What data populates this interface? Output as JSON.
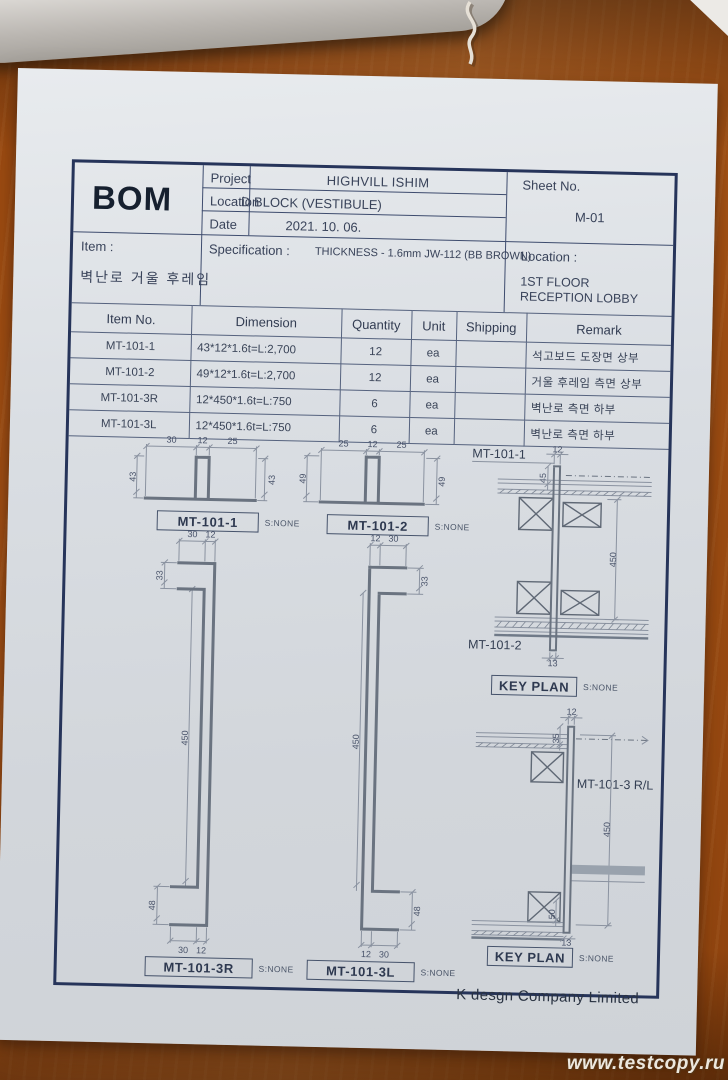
{
  "header": {
    "bom_title": "BOM",
    "project_label": "Project",
    "project_value": "HIGHVILL ISHIM",
    "location_label": "Location",
    "location_value": "D BLOCK (VESTIBULE)",
    "date_label": "Date",
    "date_value": "2021. 10. 06.",
    "sheet_label": "Sheet No.",
    "sheet_value": "M-01"
  },
  "item_block": {
    "item_label": "Item :",
    "item_value": "벽난로 거울 후레임",
    "spec_label": "Specification :",
    "spec_value": "THICKNESS - 1.6mm JW-112 (BB BROWN)",
    "location_label": "Location :",
    "location_line1": "1ST FLOOR",
    "location_line2": "RECEPTION LOBBY"
  },
  "parts_table": {
    "headers": [
      "Item No.",
      "Dimension",
      "Quantity",
      "Unit",
      "Shipping",
      "Remark"
    ],
    "rows": [
      {
        "item_no": "MT-101-1",
        "dimension": "43*12*1.6t=L:2,700",
        "quantity": "12",
        "unit": "ea",
        "shipping": "",
        "remark": "석고보드 도장면 상부"
      },
      {
        "item_no": "MT-101-2",
        "dimension": "49*12*1.6t=L:2,700",
        "quantity": "12",
        "unit": "ea",
        "shipping": "",
        "remark": "거울 후레임 측면 상부"
      },
      {
        "item_no": "MT-101-3R",
        "dimension": "12*450*1.6t=L:750",
        "quantity": "6",
        "unit": "ea",
        "shipping": "",
        "remark": "벽난로 측면 하부"
      },
      {
        "item_no": "MT-101-3L",
        "dimension": "12*450*1.6t=L:750",
        "quantity": "6",
        "unit": "ea",
        "shipping": "",
        "remark": "벽난로 측면 하부"
      }
    ]
  },
  "drawings": {
    "p1": {
      "label": "MT-101-1",
      "scale": "S:NONE",
      "top": [
        "30",
        "12",
        "25"
      ],
      "left_h": "43",
      "right_h": "43"
    },
    "p2": {
      "label": "MT-101-2",
      "scale": "S:NONE",
      "top": [
        "25",
        "12",
        "25"
      ],
      "left_h": "49",
      "right_h": "49"
    },
    "s3r": {
      "label": "MT-101-3R",
      "scale": "S:NONE",
      "top": [
        "30",
        "12"
      ],
      "hook_top": "33",
      "length": "450",
      "hook_bottom": "48",
      "bottom": [
        "30",
        "12"
      ]
    },
    "s3l": {
      "label": "MT-101-3L",
      "scale": "S:NONE",
      "top": [
        "12",
        "30"
      ],
      "hook_top": "33",
      "length": "450",
      "hook_bottom": "48",
      "bottom": [
        "12",
        "30"
      ]
    },
    "kp1": {
      "title": "KEY PLAN",
      "scale": "S:NONE",
      "callout_top": "MT-101-1",
      "callout_bottom": "MT-101-2",
      "dim_top": "12",
      "dim_top_v": "45",
      "length": "450",
      "dim_bottom": "13"
    },
    "kp2": {
      "title": "KEY PLAN",
      "scale": "S:NONE",
      "callout": "MT-101-3 R/L",
      "dim_top": "12",
      "dim_top_v": "35",
      "length": "450",
      "dim_bottom_v": "50",
      "dim_bottom": "13"
    }
  },
  "footer": {
    "company": "K desgn Company Limited"
  },
  "watermark": {
    "text": "www.testcopy.ru"
  },
  "colors": {
    "frame_ink": "#26345a",
    "paper": "#d8dce1",
    "desk_wood": "#b05817"
  }
}
